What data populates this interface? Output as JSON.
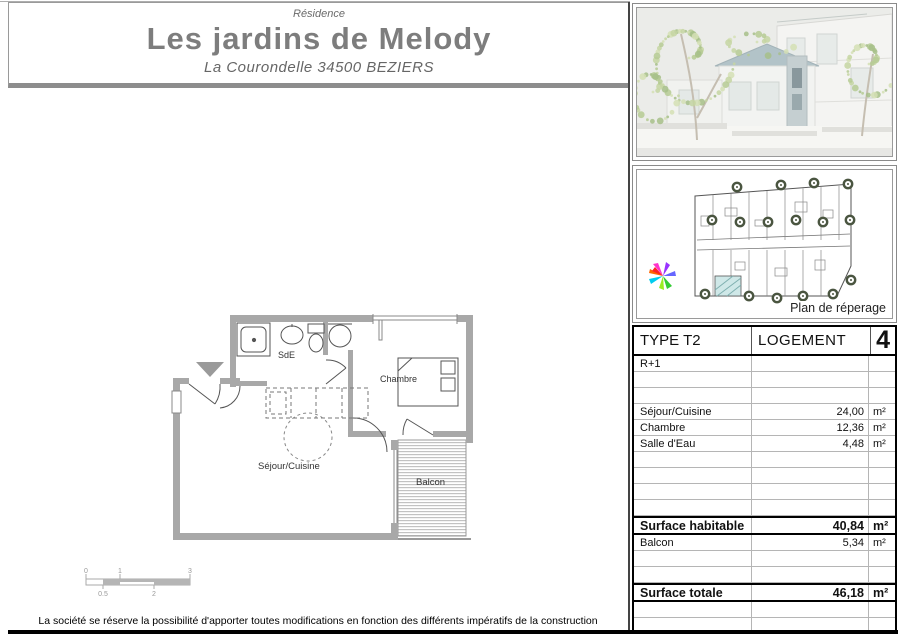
{
  "title_block": {
    "kicker": "Résidence",
    "name": "Les jardins de Melody",
    "address": "La Courondelle  34500 BEZIERS"
  },
  "floor_plan": {
    "labels": {
      "sde": "SdE",
      "chambre": "Chambre",
      "sejour": "Séjour/Cuisine",
      "balcon": "Balcon"
    },
    "scale_bar": {
      "top": [
        "0",
        "1",
        "3"
      ],
      "bottom": [
        "0.5",
        "2"
      ]
    }
  },
  "right_column": {
    "site_caption": "Plan de réperage",
    "table": {
      "header": {
        "col1": "TYPE T2",
        "col2": "LOGEMENT",
        "col3": "4"
      },
      "rows": [
        {
          "label": "R+1",
          "value": "",
          "unit": ""
        },
        {
          "label": "",
          "value": "",
          "unit": ""
        },
        {
          "label": "",
          "value": "",
          "unit": ""
        },
        {
          "label": "Séjour/Cuisine",
          "value": "24,00",
          "unit": "m²"
        },
        {
          "label": "Chambre",
          "value": "12,36",
          "unit": "m²"
        },
        {
          "label": "Salle d'Eau",
          "value": "4,48",
          "unit": "m²"
        },
        {
          "label": "",
          "value": "",
          "unit": ""
        },
        {
          "label": "",
          "value": "",
          "unit": ""
        },
        {
          "label": "",
          "value": "",
          "unit": ""
        },
        {
          "label": "",
          "value": "",
          "unit": ""
        },
        {
          "label": "Surface habitable",
          "value": "40,84",
          "unit": "m²",
          "emphasis": true
        },
        {
          "label": "Balcon",
          "value": "5,34",
          "unit": "m²"
        },
        {
          "label": "",
          "value": "",
          "unit": ""
        },
        {
          "label": "",
          "value": "",
          "unit": ""
        },
        {
          "label": "Surface totale",
          "value": "46,18",
          "unit": "m²",
          "emphasis": true
        },
        {
          "label": "",
          "value": "",
          "unit": ""
        },
        {
          "label": "",
          "value": "",
          "unit": ""
        }
      ]
    }
  },
  "footer": {
    "disclaimer": "La société se réserve la possibilité d'apporter toutes modifications en fonction des différents impératifs de la construction"
  },
  "colors": {
    "title_gray": "#7d7d7d",
    "wall_gray": "#a8a8a8",
    "highlight_teal": "#bfe0e0"
  }
}
